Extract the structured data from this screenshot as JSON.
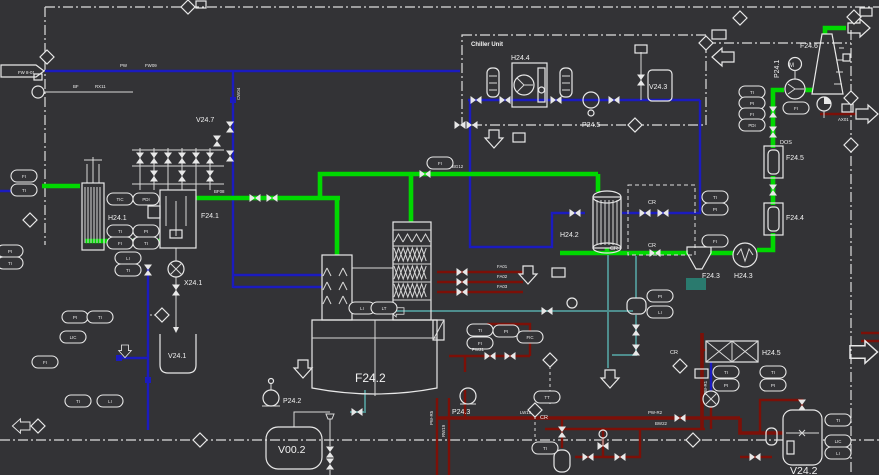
{
  "diagram": {
    "colors": {
      "background": "#333336",
      "line_white": "#e8e8e8",
      "pipe_blue": "#1b1bbf",
      "pipe_green": "#00d800",
      "pipe_red": "#7c1008",
      "pipe_teal": "#4e8d8d"
    },
    "labels": {
      "chiller": "Chiller Unit",
      "h24_1": "H24.1",
      "f24_1": "F24.1",
      "v24_7": "V24.7",
      "x24_1": "X24.1",
      "v24_1": "V24.1",
      "f24_2": "F24.2",
      "v00_2": "V00.2",
      "p24_2": "P24.2",
      "p24_3": "P24.3",
      "h24_2": "H24.2",
      "h24_4": "H24.4",
      "v24_3": "V24.3",
      "p24_5": "P24.5",
      "f24_6": "F24.6",
      "p24_1": "P24.1",
      "m": "M",
      "f24_5": "F24.5",
      "f24_4": "F24.4",
      "f24_3": "F24.3",
      "h24_3": "H24.3",
      "h24_5": "H24.5",
      "v24_2": "V24.2",
      "cr": "CR",
      "dos": "DOS"
    },
    "instruments": [
      {
        "x": 24,
        "y": 176,
        "tag": "FI"
      },
      {
        "x": 24,
        "y": 190,
        "tag": "TI"
      },
      {
        "x": 10,
        "y": 251,
        "tag": "PI"
      },
      {
        "x": 10,
        "y": 263,
        "tag": "TI"
      },
      {
        "x": 120,
        "y": 199,
        "tag": "TIC"
      },
      {
        "x": 146,
        "y": 199,
        "tag": "PDI"
      },
      {
        "x": 120,
        "y": 231,
        "tag": "TI"
      },
      {
        "x": 146,
        "y": 231,
        "tag": "PI"
      },
      {
        "x": 120,
        "y": 243,
        "tag": "FI"
      },
      {
        "x": 146,
        "y": 243,
        "tag": "TI"
      },
      {
        "x": 128,
        "y": 258,
        "tag": "LI"
      },
      {
        "x": 128,
        "y": 270,
        "tag": "TI"
      },
      {
        "x": 75,
        "y": 317,
        "tag": "PI"
      },
      {
        "x": 100,
        "y": 317,
        "tag": "TI"
      },
      {
        "x": 73,
        "y": 337,
        "tag": "LIC"
      },
      {
        "x": 45,
        "y": 362,
        "tag": "FI"
      },
      {
        "x": 78,
        "y": 401,
        "tag": "TI"
      },
      {
        "x": 110,
        "y": 401,
        "tag": "LI"
      },
      {
        "x": 440,
        "y": 163,
        "tag": "FI"
      },
      {
        "x": 362,
        "y": 308,
        "tag": "LI"
      },
      {
        "x": 384,
        "y": 308,
        "tag": "LT"
      },
      {
        "x": 480,
        "y": 330,
        "tag": "TI"
      },
      {
        "x": 506,
        "y": 331,
        "tag": "PI"
      },
      {
        "x": 480,
        "y": 343,
        "tag": "FI"
      },
      {
        "x": 530,
        "y": 337,
        "tag": "FIC"
      },
      {
        "x": 547,
        "y": 397,
        "tag": "TT"
      },
      {
        "x": 545,
        "y": 448,
        "tag": "TI"
      },
      {
        "x": 660,
        "y": 296,
        "tag": "PI"
      },
      {
        "x": 660,
        "y": 312,
        "tag": "LI"
      },
      {
        "x": 715,
        "y": 197,
        "tag": "TI"
      },
      {
        "x": 715,
        "y": 209,
        "tag": "PI"
      },
      {
        "x": 715,
        "y": 241,
        "tag": "FI"
      },
      {
        "x": 752,
        "y": 92,
        "tag": "TI"
      },
      {
        "x": 752,
        "y": 103,
        "tag": "PI"
      },
      {
        "x": 752,
        "y": 114,
        "tag": "FI"
      },
      {
        "x": 752,
        "y": 125,
        "tag": "PDI"
      },
      {
        "x": 796,
        "y": 108,
        "tag": "FI"
      },
      {
        "x": 726,
        "y": 372,
        "tag": "TI"
      },
      {
        "x": 726,
        "y": 385,
        "tag": "PI"
      },
      {
        "x": 773,
        "y": 372,
        "tag": "TI"
      },
      {
        "x": 773,
        "y": 385,
        "tag": "PI"
      },
      {
        "x": 838,
        "y": 420,
        "tag": "TI"
      },
      {
        "x": 838,
        "y": 441,
        "tag": "LIC"
      },
      {
        "x": 838,
        "y": 453,
        "tag": "LI"
      }
    ],
    "valves": [
      {
        "x": 255,
        "y": 198,
        "o": "h"
      },
      {
        "x": 272,
        "y": 198,
        "o": "h"
      },
      {
        "x": 130,
        "y": 241,
        "o": "h"
      },
      {
        "x": 425,
        "y": 174,
        "o": "h"
      },
      {
        "x": 655,
        "y": 253,
        "o": "h"
      },
      {
        "x": 773,
        "y": 190,
        "o": "v"
      },
      {
        "x": 773,
        "y": 132,
        "o": "v"
      },
      {
        "x": 773,
        "y": 112,
        "o": "v"
      },
      {
        "x": 476,
        "y": 100,
        "o": "h"
      },
      {
        "x": 505,
        "y": 100,
        "o": "h"
      },
      {
        "x": 556,
        "y": 100,
        "o": "h"
      },
      {
        "x": 614,
        "y": 100,
        "o": "h"
      },
      {
        "x": 575,
        "y": 213,
        "o": "h"
      },
      {
        "x": 645,
        "y": 213,
        "o": "h"
      },
      {
        "x": 663,
        "y": 213,
        "o": "h"
      },
      {
        "x": 641,
        "y": 80,
        "o": "v"
      },
      {
        "x": 230,
        "y": 127,
        "o": "v"
      },
      {
        "x": 230,
        "y": 156,
        "o": "v"
      },
      {
        "x": 217,
        "y": 141,
        "o": "v"
      },
      {
        "x": 140,
        "y": 158,
        "o": "v"
      },
      {
        "x": 154,
        "y": 158,
        "o": "v"
      },
      {
        "x": 168,
        "y": 158,
        "o": "v"
      },
      {
        "x": 182,
        "y": 158,
        "o": "v"
      },
      {
        "x": 196,
        "y": 158,
        "o": "v"
      },
      {
        "x": 210,
        "y": 158,
        "o": "v"
      },
      {
        "x": 154,
        "y": 176,
        "o": "v"
      },
      {
        "x": 182,
        "y": 176,
        "o": "v"
      },
      {
        "x": 210,
        "y": 176,
        "o": "v"
      },
      {
        "x": 460,
        "y": 125,
        "o": "h"
      },
      {
        "x": 472,
        "y": 125,
        "o": "h"
      },
      {
        "x": 462,
        "y": 272,
        "o": "h"
      },
      {
        "x": 462,
        "y": 282,
        "o": "h"
      },
      {
        "x": 462,
        "y": 292,
        "o": "h"
      },
      {
        "x": 490,
        "y": 356,
        "o": "h"
      },
      {
        "x": 510,
        "y": 356,
        "o": "h"
      },
      {
        "x": 680,
        "y": 418,
        "o": "h"
      },
      {
        "x": 588,
        "y": 457,
        "o": "h"
      },
      {
        "x": 620,
        "y": 457,
        "o": "h"
      },
      {
        "x": 755,
        "y": 457,
        "o": "h"
      },
      {
        "x": 802,
        "y": 405,
        "o": "v"
      },
      {
        "x": 562,
        "y": 432,
        "o": "v"
      },
      {
        "x": 547,
        "y": 311,
        "o": "h"
      },
      {
        "x": 357,
        "y": 412,
        "o": "h"
      },
      {
        "x": 636,
        "y": 330,
        "o": "v"
      },
      {
        "x": 636,
        "y": 350,
        "o": "v"
      },
      {
        "x": 330,
        "y": 452,
        "o": "v"
      },
      {
        "x": 330,
        "y": 464,
        "o": "v"
      },
      {
        "x": 176,
        "y": 290,
        "o": "v"
      },
      {
        "x": 148,
        "y": 270,
        "o": "v"
      }
    ],
    "diamonds": [
      {
        "x": 188,
        "y": 7
      },
      {
        "x": 47,
        "y": 57
      },
      {
        "x": 706,
        "y": 43
      },
      {
        "x": 635,
        "y": 125
      },
      {
        "x": 740,
        "y": 18
      },
      {
        "x": 854,
        "y": 17
      },
      {
        "x": 851,
        "y": 98
      },
      {
        "x": 851,
        "y": 145
      },
      {
        "x": 162,
        "y": 315
      },
      {
        "x": 30,
        "y": 220
      },
      {
        "x": 550,
        "y": 360
      },
      {
        "x": 535,
        "y": 410
      },
      {
        "x": 680,
        "y": 366
      },
      {
        "x": 693,
        "y": 440
      },
      {
        "x": 200,
        "y": 440
      },
      {
        "x": 38,
        "y": 426
      }
    ],
    "pipe_labels": [
      {
        "x": 120,
        "y": 67,
        "text": "PW"
      },
      {
        "x": 145,
        "y": 67,
        "text": "FW09"
      },
      {
        "x": 18,
        "y": 74,
        "text": "FW 8-01"
      },
      {
        "x": 73,
        "y": 88,
        "text": "BF"
      },
      {
        "x": 95,
        "y": 88,
        "text": "RX11"
      },
      {
        "x": 214,
        "y": 193,
        "text": "BF08"
      },
      {
        "x": 452,
        "y": 168,
        "text": "BG12"
      },
      {
        "x": 497,
        "y": 268,
        "text": "FA01"
      },
      {
        "x": 497,
        "y": 278,
        "text": "FA02"
      },
      {
        "x": 497,
        "y": 288,
        "text": "FA03"
      },
      {
        "x": 472,
        "y": 351,
        "text": "PW21"
      },
      {
        "x": 520,
        "y": 414,
        "text": "LW15"
      },
      {
        "x": 648,
        "y": 414,
        "text": "PW-R2"
      },
      {
        "x": 655,
        "y": 425,
        "text": "BW22"
      },
      {
        "x": 838,
        "y": 121,
        "text": "AX01",
        "color": "#a83030"
      },
      {
        "x": 433,
        "y": 425,
        "text": "PW-R5",
        "rot": -90
      },
      {
        "x": 445,
        "y": 437,
        "text": "RW19",
        "rot": -90
      },
      {
        "x": 707,
        "y": 395,
        "text": "PW-R1",
        "rot": -90
      },
      {
        "x": 240,
        "y": 100,
        "text": "CW04",
        "rot": -90
      }
    ]
  }
}
